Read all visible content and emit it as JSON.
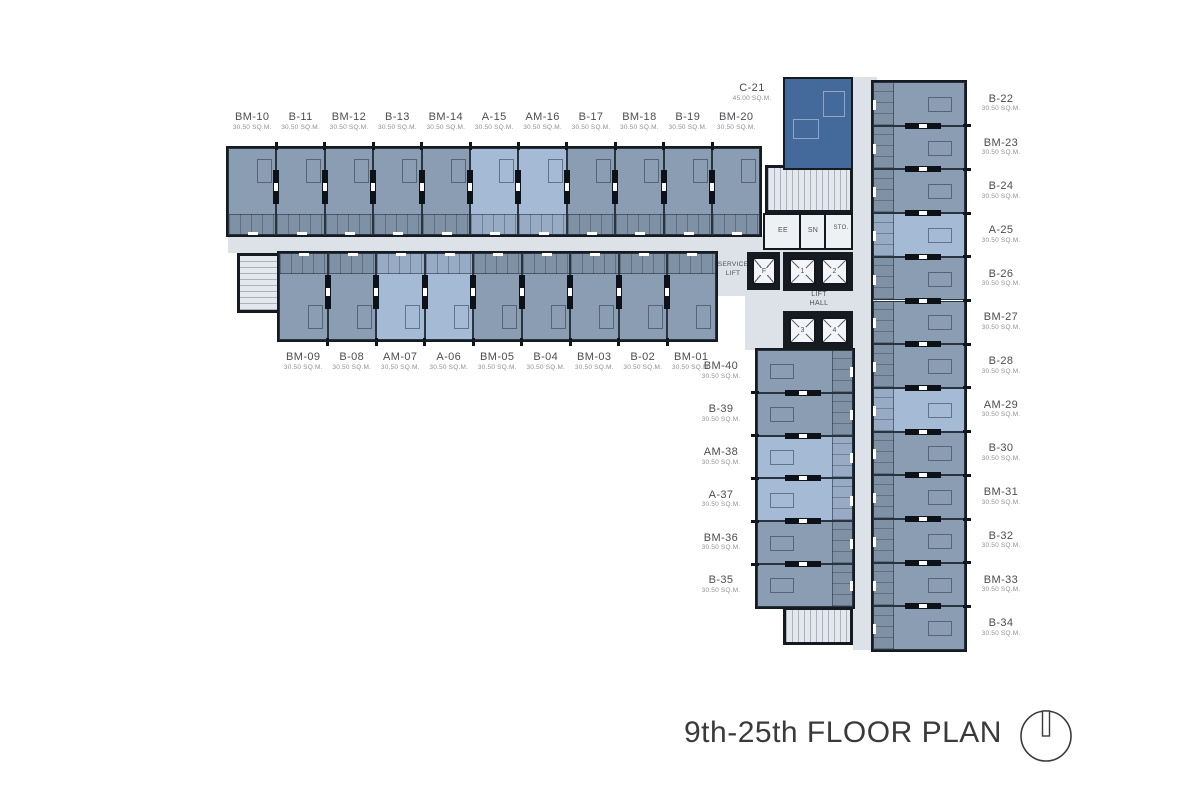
{
  "title": "9th-25th FLOOR PLAN",
  "colors": {
    "unit_a_light_blue": "#a5bad4",
    "unit_b_slate": "#8a9db2",
    "unit_c_dark": "#44699b",
    "corridor": "#dde2e9",
    "stair": "#e3e8ee",
    "wall": "#161b21",
    "label_text": "#4d4d50",
    "area_text": "#8f9093",
    "title_text": "#3a3a3c"
  },
  "units": {
    "top_row": [
      {
        "name": "BM-10",
        "area": "30.50 SQ.M."
      },
      {
        "name": "B-11",
        "area": "30.50 SQ.M."
      },
      {
        "name": "BM-12",
        "area": "30.50 SQ.M."
      },
      {
        "name": "B-13",
        "area": "30.50 SQ.M."
      },
      {
        "name": "BM-14",
        "area": "30.50 SQ.M."
      },
      {
        "name": "A-15",
        "area": "30.50 SQ.M."
      },
      {
        "name": "AM-16",
        "area": "30.50 SQ.M."
      },
      {
        "name": "B-17",
        "area": "30.50 SQ.M."
      },
      {
        "name": "BM-18",
        "area": "30.50 SQ.M."
      },
      {
        "name": "B-19",
        "area": "30.50 SQ.M."
      },
      {
        "name": "BM-20",
        "area": "30.50 SQ.M."
      }
    ],
    "bottom_row": [
      {
        "name": "BM-09",
        "area": "30.50 SQ.M."
      },
      {
        "name": "B-08",
        "area": "30.50 SQ.M."
      },
      {
        "name": "AM-07",
        "area": "30.50 SQ.M."
      },
      {
        "name": "A-06",
        "area": "30.50 SQ.M."
      },
      {
        "name": "BM-05",
        "area": "30.50 SQ.M."
      },
      {
        "name": "B-04",
        "area": "30.50 SQ.M."
      },
      {
        "name": "BM-03",
        "area": "30.50 SQ.M."
      },
      {
        "name": "B-02",
        "area": "30.50 SQ.M."
      },
      {
        "name": "BM-01",
        "area": "30.50 SQ.M."
      }
    ],
    "right_column": [
      {
        "name": "B-22",
        "area": "30.50 SQ.M."
      },
      {
        "name": "BM-23",
        "area": "30.50 SQ.M."
      },
      {
        "name": "B-24",
        "area": "30.50 SQ.M."
      },
      {
        "name": "A-25",
        "area": "30.50 SQ.M."
      },
      {
        "name": "B-26",
        "area": "30.50 SQ.M."
      },
      {
        "name": "BM-27",
        "area": "30.50 SQ.M."
      },
      {
        "name": "B-28",
        "area": "30.50 SQ.M."
      },
      {
        "name": "AM-29",
        "area": "30.50 SQ.M."
      },
      {
        "name": "B-30",
        "area": "30.50 SQ.M."
      },
      {
        "name": "BM-31",
        "area": "30.50 SQ.M."
      },
      {
        "name": "B-32",
        "area": "30.50 SQ.M."
      },
      {
        "name": "BM-33",
        "area": "30.50 SQ.M."
      },
      {
        "name": "B-34",
        "area": "30.50 SQ.M."
      }
    ],
    "left_column": [
      {
        "name": "BM-40",
        "area": "30.50 SQ.M."
      },
      {
        "name": "B-39",
        "area": "30.50 SQ.M."
      },
      {
        "name": "AM-38",
        "area": "30.50 SQ.M."
      },
      {
        "name": "A-37",
        "area": "30.50 SQ.M."
      },
      {
        "name": "BM-36",
        "area": "30.50 SQ.M."
      },
      {
        "name": "B-35",
        "area": "30.50 SQ.M."
      }
    ],
    "corner_unit": {
      "name": "C-21",
      "area": "45.00 SQ.M."
    }
  },
  "core": {
    "ee": "EE",
    "sn": "SN",
    "sto": "STO.",
    "service_lift": "SERVICE\nLIFT",
    "lift_hall": "LIFT\nHALL",
    "lifts": [
      "F",
      "1",
      "2",
      "3",
      "4"
    ]
  }
}
